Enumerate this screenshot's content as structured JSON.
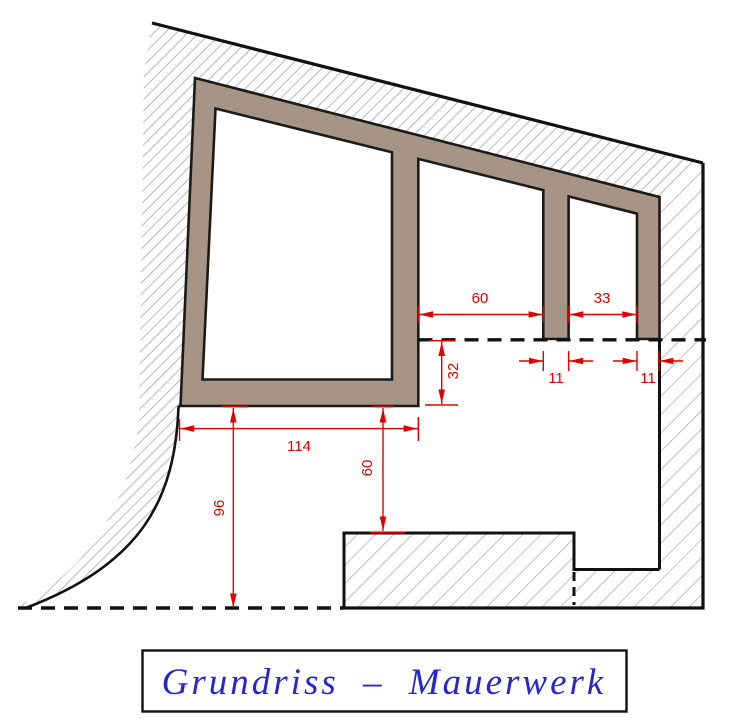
{
  "drawing": {
    "type": "floor-plan section drawing (masonry)",
    "title_block": {
      "label": "Grundriss – Mauerwerk"
    },
    "dimensions": {
      "opening_top": "60",
      "opening_right": "33",
      "pillar_mid_width": "11",
      "pillar_right_width": "11",
      "section_offset": "32",
      "room_width": "114",
      "foundation_offset": "60",
      "ground_height": "96"
    },
    "colors": {
      "wall_fill": "#a69584",
      "dimension_red": "#e00000",
      "hatch_gray": "#b8b8b8",
      "outline_black": "#111111",
      "title_blue": "#2626cc",
      "background": "#ffffff"
    }
  }
}
